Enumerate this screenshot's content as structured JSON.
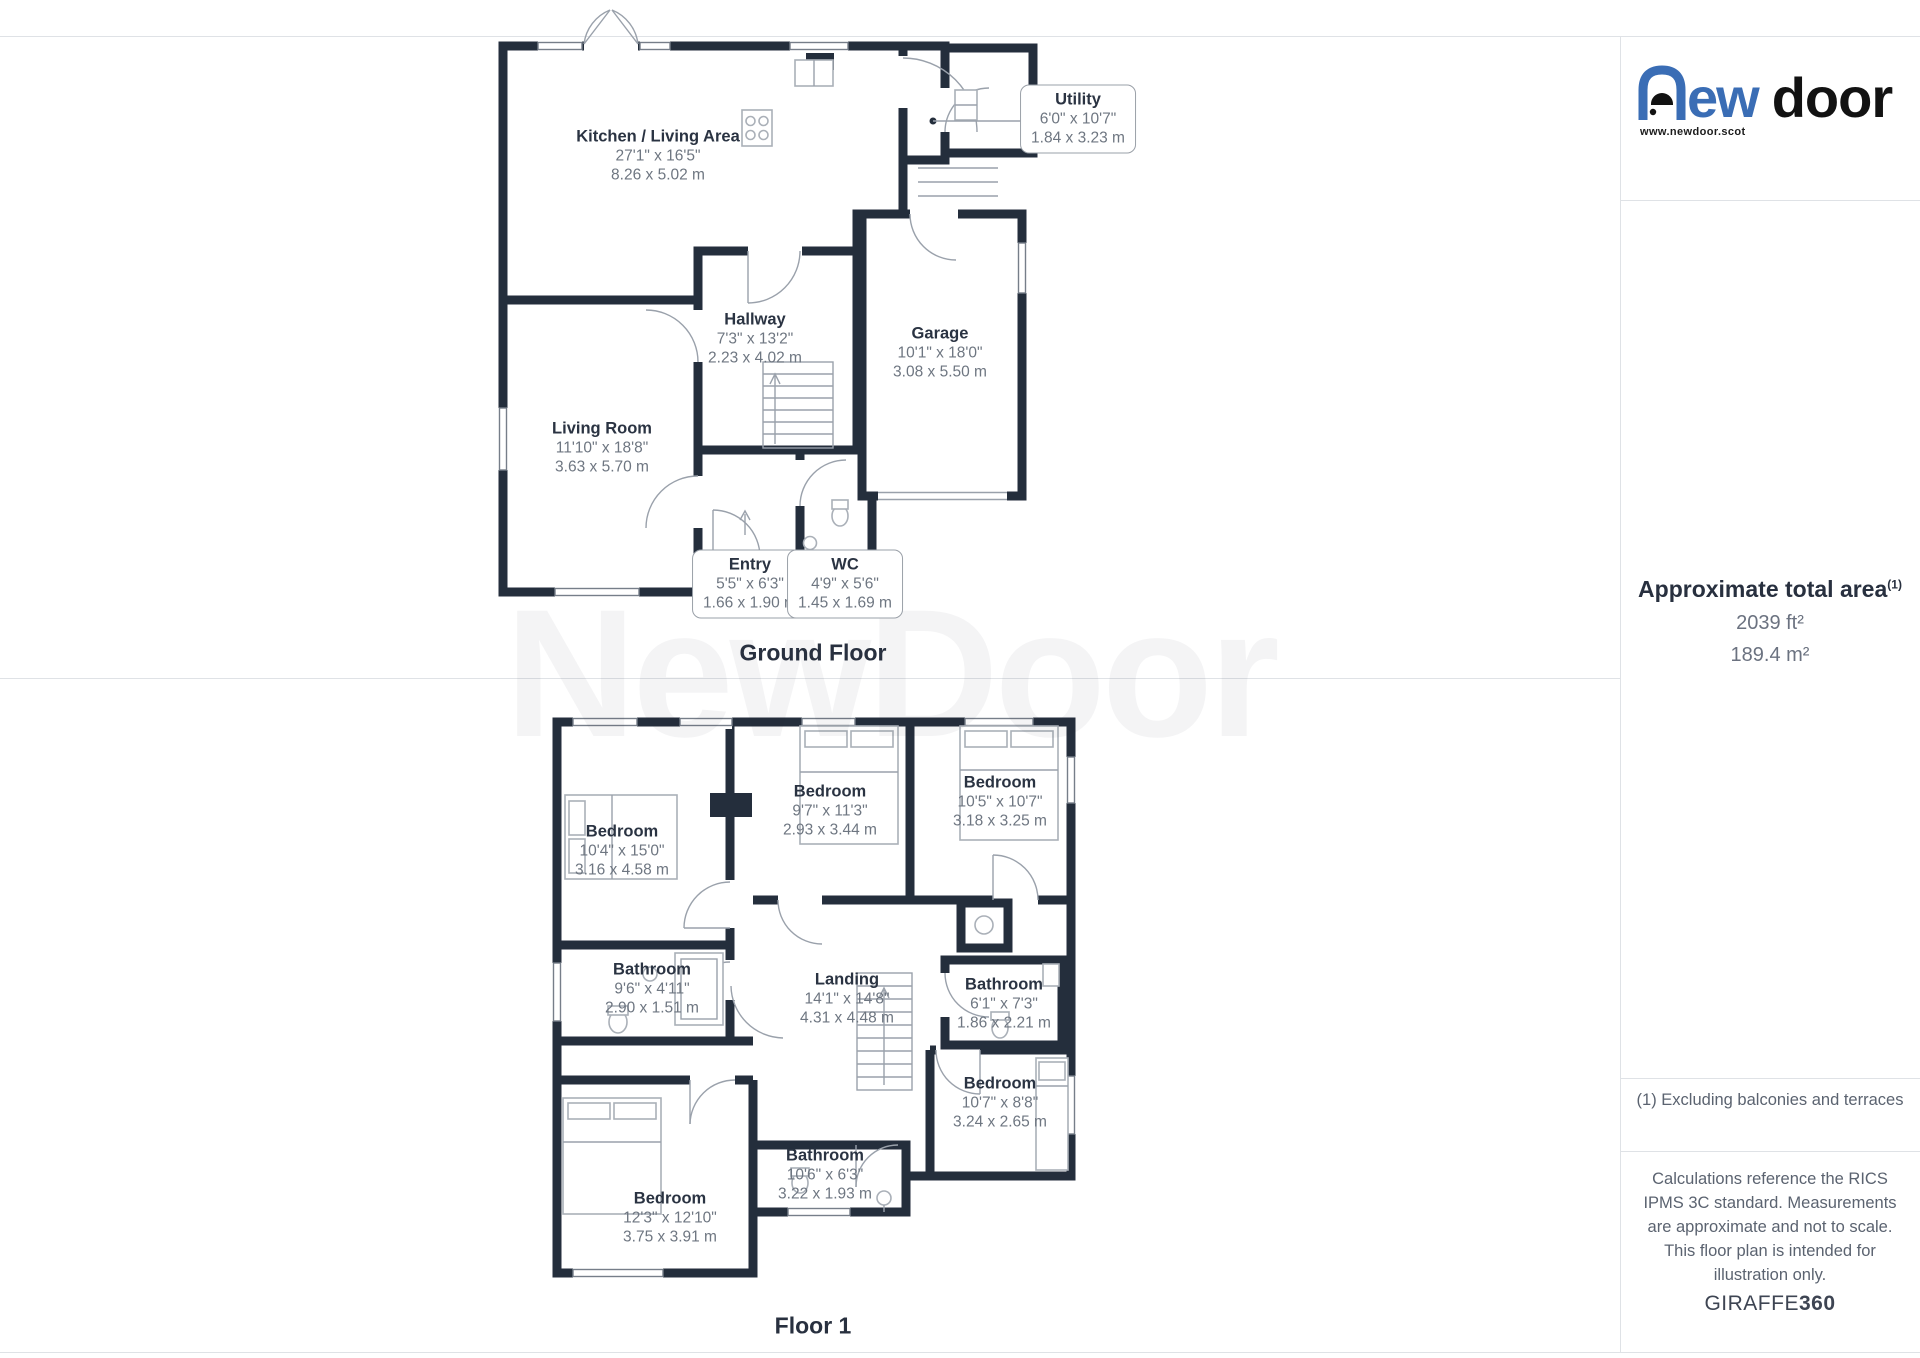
{
  "brand": {
    "logo_text_rest": "ew",
    "logo_text_door": "door",
    "website": "www.newdoor.scot",
    "logo_blue": "#3a6db5",
    "logo_black": "#121212"
  },
  "watermark": "NewDoor",
  "colors": {
    "wall": "#242e3c",
    "label_dark": "#2a3342",
    "label_gray": "#6e7681"
  },
  "sidebar": {
    "area_title": "Approximate total area",
    "area_title_sup": "(1)",
    "area_imperial": "2039 ft²",
    "area_metric": "189.4 m²",
    "footnote": "(1) Excluding balconies and terraces",
    "disclaimer": "Calculations reference the RICS IPMS 3C standard. Measurements are approximate and not to scale. This floor plan is intended for illustration only.",
    "credit_brand": "GIRAFFE",
    "credit_number": "360"
  },
  "floors": [
    {
      "label": "Ground Floor",
      "rooms": [
        {
          "name": "Kitchen / Living Area",
          "imperial": "27'1\" x 16'5\"",
          "metric": "8.26 x 5.02 m",
          "x": 658,
          "y": 156,
          "callout": false
        },
        {
          "name": "Utility",
          "imperial": "6'0\" x 10'7\"",
          "metric": "1.84 x 3.23 m",
          "x": 1078,
          "y": 119,
          "callout": true
        },
        {
          "name": "Hallway",
          "imperial": "7'3\" x 13'2\"",
          "metric": "2.23 x 4.02 m",
          "x": 755,
          "y": 339,
          "callout": false
        },
        {
          "name": "Garage",
          "imperial": "10'1\" x 18'0\"",
          "metric": "3.08 x 5.50 m",
          "x": 940,
          "y": 353,
          "callout": false
        },
        {
          "name": "Living Room",
          "imperial": "11'10\" x 18'8\"",
          "metric": "3.63 x 5.70 m",
          "x": 602,
          "y": 448,
          "callout": false
        },
        {
          "name": "Entry",
          "imperial": "5'5\" x 6'3\"",
          "metric": "1.66 x 1.90 m",
          "x": 750,
          "y": 584,
          "callout": true
        },
        {
          "name": "WC",
          "imperial": "4'9\" x 5'6\"",
          "metric": "1.45 x 1.69 m",
          "x": 845,
          "y": 584,
          "callout": true
        }
      ]
    },
    {
      "label": "Floor 1",
      "rooms": [
        {
          "name": "Bedroom",
          "imperial": "10'4\" x 15'0\"",
          "metric": "3.16 x 4.58 m",
          "x": 622,
          "y": 851,
          "callout": false
        },
        {
          "name": "Bedroom",
          "imperial": "9'7\" x 11'3\"",
          "metric": "2.93 x 3.44 m",
          "x": 830,
          "y": 811,
          "callout": false
        },
        {
          "name": "Bedroom",
          "imperial": "10'5\" x 10'7\"",
          "metric": "3.18 x 3.25 m",
          "x": 1000,
          "y": 802,
          "callout": false
        },
        {
          "name": "Bathroom",
          "imperial": "9'6\" x 4'11\"",
          "metric": "2.90 x 1.51 m",
          "x": 652,
          "y": 989,
          "callout": false
        },
        {
          "name": "Landing",
          "imperial": "14'1\" x 14'8\"",
          "metric": "4.31 x 4.48 m",
          "x": 847,
          "y": 999,
          "callout": false
        },
        {
          "name": "Bathroom",
          "imperial": "6'1\" x 7'3\"",
          "metric": "1.86 x 2.21 m",
          "x": 1004,
          "y": 1004,
          "callout": false
        },
        {
          "name": "Bedroom",
          "imperial": "10'7\" x 8'8\"",
          "metric": "3.24 x 2.65 m",
          "x": 1000,
          "y": 1103,
          "callout": false
        },
        {
          "name": "Bathroom",
          "imperial": "10'6\" x 6'3\"",
          "metric": "3.22 x 1.93 m",
          "x": 825,
          "y": 1175,
          "callout": false
        },
        {
          "name": "Bedroom",
          "imperial": "12'3\" x 12'10\"",
          "metric": "3.75 x 3.91 m",
          "x": 670,
          "y": 1218,
          "callout": false
        }
      ]
    }
  ]
}
